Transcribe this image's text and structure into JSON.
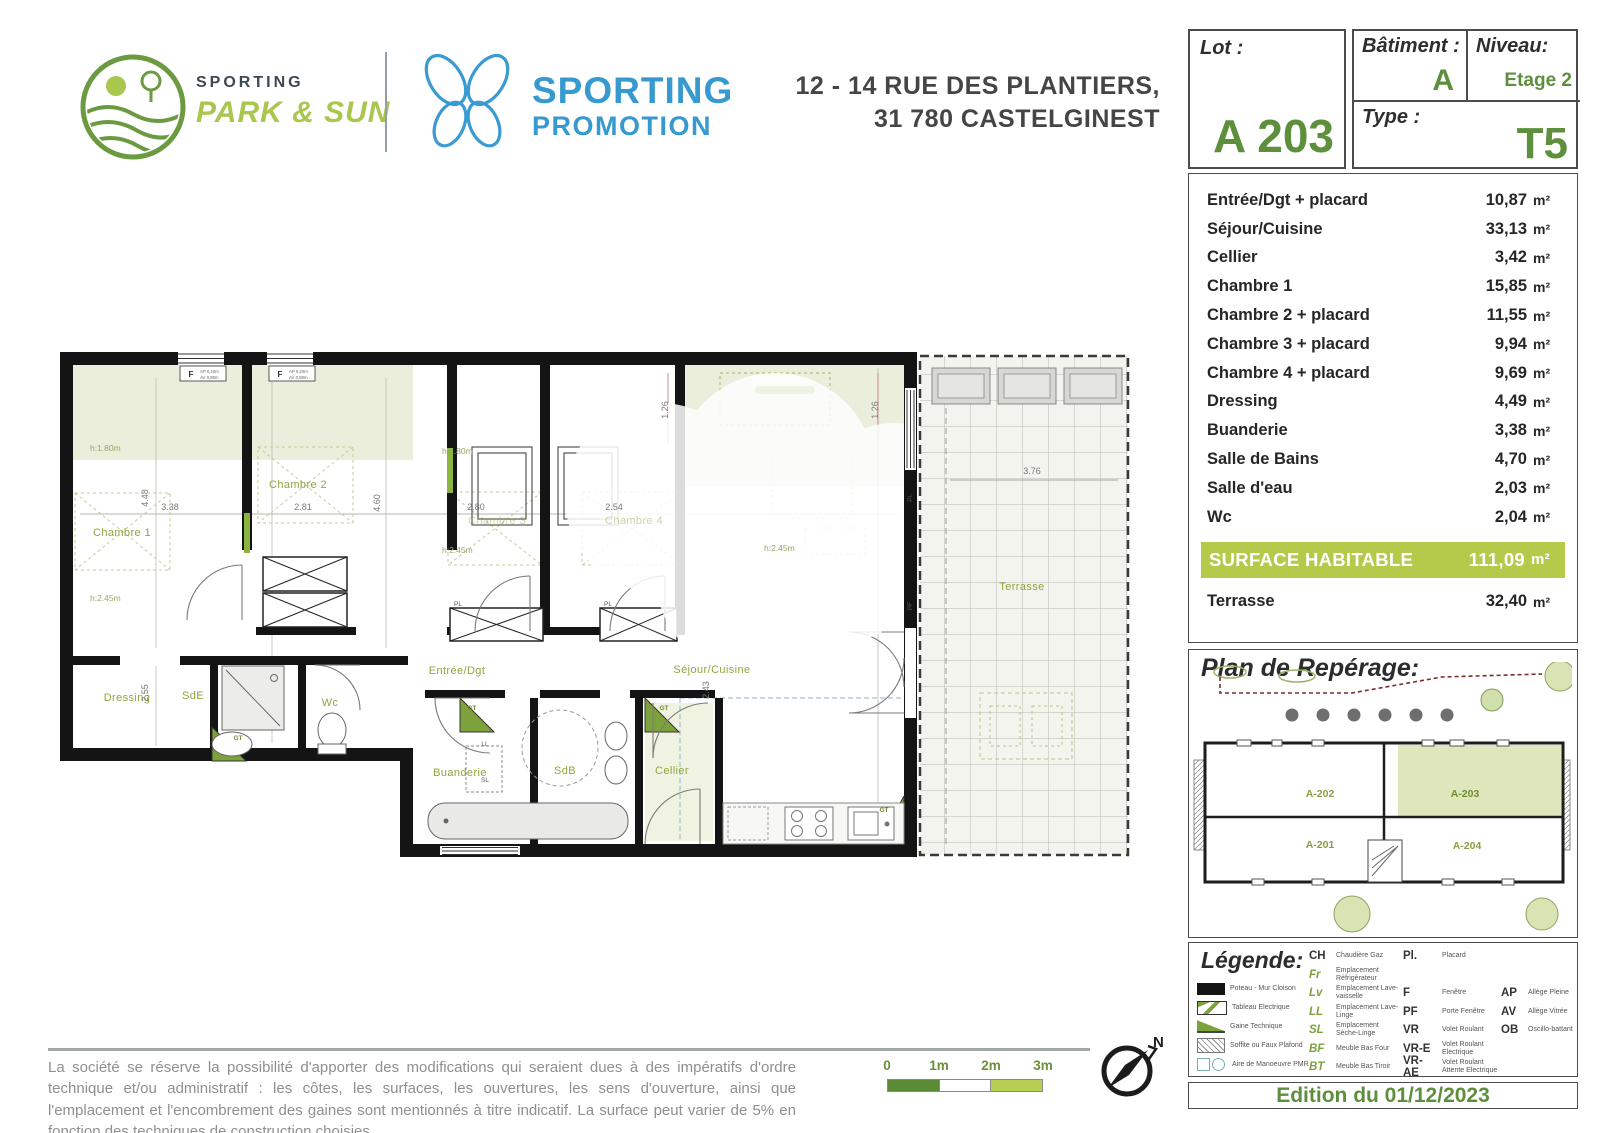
{
  "header": {
    "brand_left": {
      "line1": "SPORTING",
      "line2": "PARK & SUN"
    },
    "brand_right": {
      "line1": "SPORTING",
      "line2": "PROMOTION"
    },
    "address_line1": "12 - 14 RUE DES PLANTIERS,",
    "address_line2": "31 780 CASTELGINEST"
  },
  "lot": {
    "label": "Lot :",
    "value": "A 203"
  },
  "batiment": {
    "label": "Bâtiment :",
    "value": "A"
  },
  "niveau": {
    "label": "Niveau:",
    "value": "Etage 2"
  },
  "type": {
    "label": "Type :",
    "value": "T5"
  },
  "areas": {
    "rows": [
      {
        "label": "Entrée/Dgt + placard",
        "value": "10,87",
        "unit": "m²"
      },
      {
        "label": "Séjour/Cuisine",
        "value": "33,13",
        "unit": "m²"
      },
      {
        "label": "Cellier",
        "value": "3,42",
        "unit": "m²"
      },
      {
        "label": "Chambre 1",
        "value": "15,85",
        "unit": "m²"
      },
      {
        "label": "Chambre 2 + placard",
        "value": "11,55",
        "unit": "m²"
      },
      {
        "label": "Chambre 3 + placard",
        "value": "9,94",
        "unit": "m²"
      },
      {
        "label": "Chambre 4 + placard",
        "value": "9,69",
        "unit": "m²"
      },
      {
        "label": "Dressing",
        "value": "4,49",
        "unit": "m²"
      },
      {
        "label": "Buanderie",
        "value": "3,38",
        "unit": "m²"
      },
      {
        "label": "Salle de Bains",
        "value": "4,70",
        "unit": "m²"
      },
      {
        "label": "Salle d'eau",
        "value": "2,03",
        "unit": "m²"
      },
      {
        "label": "Wc",
        "value": "2,04",
        "unit": "m²"
      }
    ],
    "surface": {
      "label": "SURFACE HABITABLE",
      "value": "111,09",
      "unit": "m²"
    },
    "terrace": {
      "label": "Terrasse",
      "value": "32,40",
      "unit": "m²"
    }
  },
  "reperage": {
    "title": "Plan de Repérage:",
    "units": [
      {
        "id": "A-202",
        "x": 128,
        "y": 135,
        "hl": false
      },
      {
        "id": "A-203",
        "x": 273,
        "y": 135,
        "hl": true
      },
      {
        "id": "A-201",
        "x": 128,
        "y": 186,
        "hl": false
      },
      {
        "id": "A-204",
        "x": 275,
        "y": 187,
        "hl": false
      }
    ]
  },
  "legend": {
    "title": "Légende:",
    "icons": [
      {
        "type": "wall",
        "label": "Poteau - Mur Cloison"
      },
      {
        "type": "tableau",
        "label": "Tableau Electrique"
      },
      {
        "type": "gaine",
        "label": "Gaine Technique"
      },
      {
        "type": "soffite",
        "label": "Soffite ou Faux Plafond"
      },
      {
        "type": "pmr",
        "label": "Aire de Manoeuvre PMR"
      }
    ],
    "equip": [
      {
        "abbr": "CH",
        "label": "Chaudière Gaz",
        "green": false,
        "row": 0
      },
      {
        "abbr": "Fr",
        "label": "Emplacement Réfrigérateur",
        "green": true,
        "row": 1
      },
      {
        "abbr": "Lv",
        "label": "Emplacement Lave-vaisselle",
        "green": true,
        "row": 2
      },
      {
        "abbr": "LL",
        "label": "Emplacement Lave-Linge",
        "green": true,
        "row": 3
      },
      {
        "abbr": "SL",
        "label": "Emplacement Sèche-Linge",
        "green": true,
        "row": 4
      },
      {
        "abbr": "BF",
        "label": "Meuble Bas Four",
        "green": true,
        "row": 5
      },
      {
        "abbr": "BT",
        "label": "Meuble Bas Tiroir",
        "green": true,
        "row": 6
      }
    ],
    "openings": [
      {
        "abbr": "Pl.",
        "label": "Placard",
        "row": 0
      },
      {
        "abbr": "F",
        "label": "Fenêtre",
        "row": 2
      },
      {
        "abbr": "PF",
        "label": "Porte Fenêtre",
        "row": 3
      },
      {
        "abbr": "VR",
        "label": "Volet Roulant",
        "row": 4
      },
      {
        "abbr": "VR-E",
        "label": "Volet Roulant Electrique",
        "row": 5
      },
      {
        "abbr": "VR-AE",
        "label": "Volet Roulant Attente Electrique",
        "row": 6
      }
    ],
    "alleges": [
      {
        "abbr": "AP",
        "label": "Allège Pleine",
        "row": 2
      },
      {
        "abbr": "AV",
        "label": "Allège Vitrée",
        "row": 3
      },
      {
        "abbr": "OB",
        "label": "Oscillo-battant",
        "row": 4
      }
    ]
  },
  "plan": {
    "room_labels": [
      {
        "text": "Chambre 1",
        "x": 62,
        "y": 188,
        "cls": "room"
      },
      {
        "text": "Chambre 2",
        "x": 238,
        "y": 140,
        "cls": "room"
      },
      {
        "text": "Chambre 3",
        "x": 437,
        "y": 176,
        "cls": "room faint"
      },
      {
        "text": "Chambre 4",
        "x": 574,
        "y": 176,
        "cls": "room faint"
      },
      {
        "text": "Entrée/Dgt",
        "x": 397,
        "y": 326,
        "cls": "room"
      },
      {
        "text": "Séjour/Cuisine",
        "x": 652,
        "y": 325,
        "cls": "room"
      },
      {
        "text": "Dressing",
        "x": 67,
        "y": 353,
        "cls": "room"
      },
      {
        "text": "SdE",
        "x": 133,
        "y": 351,
        "cls": "room"
      },
      {
        "text": "Wc",
        "x": 270,
        "y": 358,
        "cls": "room"
      },
      {
        "text": "Buanderie",
        "x": 400,
        "y": 428,
        "cls": "room"
      },
      {
        "text": "SdB",
        "x": 505,
        "y": 426,
        "cls": "room"
      },
      {
        "text": "Cellier",
        "x": 612,
        "y": 426,
        "cls": "room"
      },
      {
        "text": "Terrasse",
        "x": 962,
        "y": 242,
        "cls": "room"
      }
    ],
    "dim_labels": [
      {
        "text": "4.48",
        "x": 88,
        "y": 150,
        "rot": -90
      },
      {
        "text": "3.38",
        "x": 110,
        "y": 162
      },
      {
        "text": "2.81",
        "x": 243,
        "y": 162
      },
      {
        "text": "4.60",
        "x": 320,
        "y": 155,
        "rot": -90
      },
      {
        "text": "2.80",
        "x": 416,
        "y": 162
      },
      {
        "text": "2.54",
        "x": 554,
        "y": 162
      },
      {
        "text": "2.55",
        "x": 88,
        "y": 345,
        "rot": -90
      },
      {
        "text": "2.43",
        "x": 649,
        "y": 342,
        "rot": -90
      },
      {
        "text": "1.26",
        "x": 608,
        "y": 62,
        "rot": -90
      },
      {
        "text": "1.26",
        "x": 818,
        "y": 62,
        "rot": -90
      },
      {
        "text": "3.76",
        "x": 972,
        "y": 126
      }
    ],
    "h_labels": [
      {
        "text": "h:1.80m",
        "x": 30,
        "y": 103
      },
      {
        "text": "h:2.45m",
        "x": 30,
        "y": 253
      },
      {
        "text": "h:1.80m",
        "x": 382,
        "y": 106
      },
      {
        "text": "h:2.45m",
        "x": 382,
        "y": 205
      },
      {
        "text": "h:2.45m",
        "x": 704,
        "y": 203
      }
    ],
    "tiny_labels": [
      {
        "text": "F",
        "x": 131,
        "y": 29,
        "cls": "wlabel"
      },
      {
        "text": "AP 0,20m",
        "x": 140,
        "y": 25,
        "cls": "wnote"
      },
      {
        "text": "AV 0,80m",
        "x": 140,
        "y": 31,
        "cls": "wnote"
      },
      {
        "text": "F",
        "x": 220,
        "y": 29,
        "cls": "wlabel"
      },
      {
        "text": "AP 0,20m",
        "x": 229,
        "y": 25,
        "cls": "wnote"
      },
      {
        "text": "AV 0,80m",
        "x": 229,
        "y": 31,
        "cls": "wnote"
      },
      {
        "text": "PL",
        "x": 398,
        "y": 258,
        "cls": "tiny"
      },
      {
        "text": "PL",
        "x": 548,
        "y": 258,
        "cls": "tiny"
      },
      {
        "text": "GT",
        "x": 178,
        "y": 392,
        "cls": "tinyg"
      },
      {
        "text": "GT",
        "x": 412,
        "y": 362,
        "cls": "tinyg"
      },
      {
        "text": "GT",
        "x": 604,
        "y": 362,
        "cls": "tinyg"
      },
      {
        "text": "GT",
        "x": 824,
        "y": 464,
        "cls": "tinyg"
      },
      {
        "text": "LL",
        "x": 425,
        "y": 398,
        "cls": "tiny"
      },
      {
        "text": "SL",
        "x": 425,
        "y": 434,
        "cls": "tiny"
      },
      {
        "text": "PF",
        "x": 852,
        "y": 258,
        "cls": "tiny",
        "rot": -90
      },
      {
        "text": "Pl.",
        "x": 852,
        "y": 150,
        "cls": "tiny",
        "rot": -90
      }
    ]
  },
  "footer": {
    "disclaimer": "La société se réserve la possibilité d'apporter des modifications qui seraient dues à des impératifs d'ordre technique et/ou administratif : les côtes, les surfaces, les ouvertures, les sens d'ouverture, ainsi que l'emplacement et l'encombrement des gaines sont mentionnés à titre indicatif. La surface peut varier de 5% en fonction des techniques de construction choisies.",
    "scale": {
      "ticks": [
        "0",
        "1m",
        "2m",
        "3m"
      ]
    },
    "compass_label": "N"
  },
  "edition": "Edition du 01/12/2023",
  "colors": {
    "brand_green": "#5d8f3d",
    "brand_light_green": "#a9c74f",
    "brand_blue": "#3699cf",
    "surface_band": "#b5ca4b",
    "highlight_unit": "#dfe6bc",
    "scale_dark": "#5a8a33",
    "scale_light": "#b4cf52"
  }
}
